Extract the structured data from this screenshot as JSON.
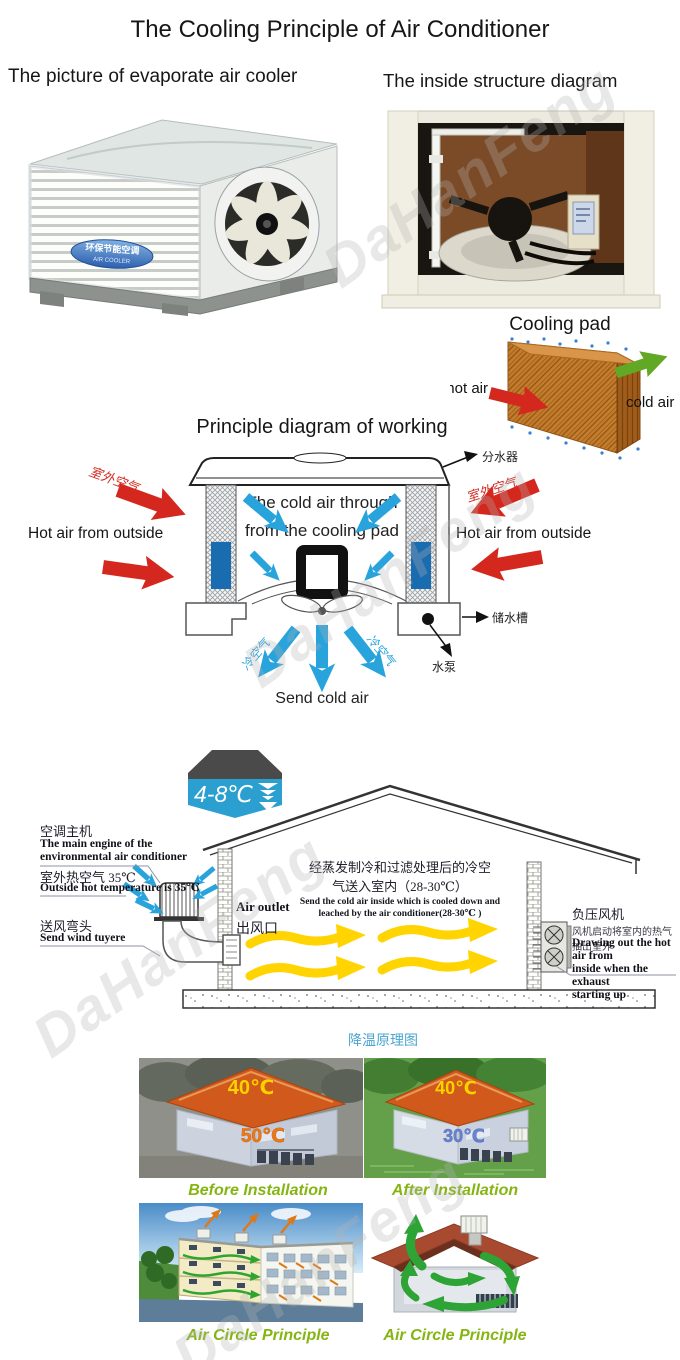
{
  "page": {
    "title": "The Cooling Principle of Air Conditioner",
    "watermark": "DaHanFeng"
  },
  "photo_section": {
    "title": "The picture of evaporate air cooler",
    "unit_label_cn": "环保节能空调",
    "unit_label_en": "AIR COOLER"
  },
  "structure_section": {
    "title": "The inside structure diagram"
  },
  "cooling_pad": {
    "title": "Cooling pad",
    "hot_air_label": "hot air",
    "cold_air_label": "cold air"
  },
  "principle": {
    "title": "Principle diagram of working",
    "inner_line1": "The cold air through",
    "inner_line2": "from the cooling pad",
    "hot_air_left": "Hot air from outside",
    "hot_air_right": "Hot air from outside",
    "outdoor_air_cn": "室外空气",
    "cold_air_cn": "冷空气",
    "water_distributor_cn": "分水器",
    "water_tank_cn": "储水槽",
    "water_pump_cn": "水泵",
    "send_cold_air": "Send cold air"
  },
  "house": {
    "temp_badge": "4-8℃",
    "engine_cn": "空调主机",
    "engine_en1": "The main engine of the",
    "engine_en2": "environmental air conditioner",
    "outside_temp_cn": "室外热空气 35℃",
    "outside_temp_en": "Outside hot temperature is 35℃",
    "tuyere_cn": "送风弯头",
    "tuyere_en": "Send wind tuyere",
    "air_outlet_en": "Air outlet",
    "air_outlet_cn": "出风口",
    "center_cn1": "经蒸发制冷和过滤处理后的冷空",
    "center_cn2": "气送入室内（28-30℃）",
    "center_en1": "Send the cold air inside which is cooled down and",
    "center_en2": "leached by the air conditioner(28-30℃ )",
    "exhaust_cn": "负压风机",
    "exhaust_desc_cn": "风机启动将室内的热气抽出室外",
    "exhaust_en1": "Drawing out the hot air from",
    "exhaust_en2": "inside when the exhaust",
    "exhaust_en3": "starting up",
    "caption_cn": "降温原理图"
  },
  "comparison": {
    "before_roof_temp": "40℃",
    "before_inside_temp": "50℃",
    "before_caption": "Before Installation",
    "after_roof_temp": "40℃",
    "after_inside_temp": "30℃",
    "after_caption": "After Installation"
  },
  "circulation": {
    "left_caption": "Air Circle Principle",
    "right_caption": "Air Circle Principle"
  },
  "colors": {
    "hot_arrow_red": "#d4281e",
    "cold_arrow_blue": "#29a3dc",
    "cold_air_green": "#61a824",
    "pad_orange": "#c57d2c",
    "badge_blue": "#2ba0d0",
    "yellow_arrow": "#ffd400",
    "caption_green": "#85b512",
    "caption_blue": "#4aa5cf"
  }
}
